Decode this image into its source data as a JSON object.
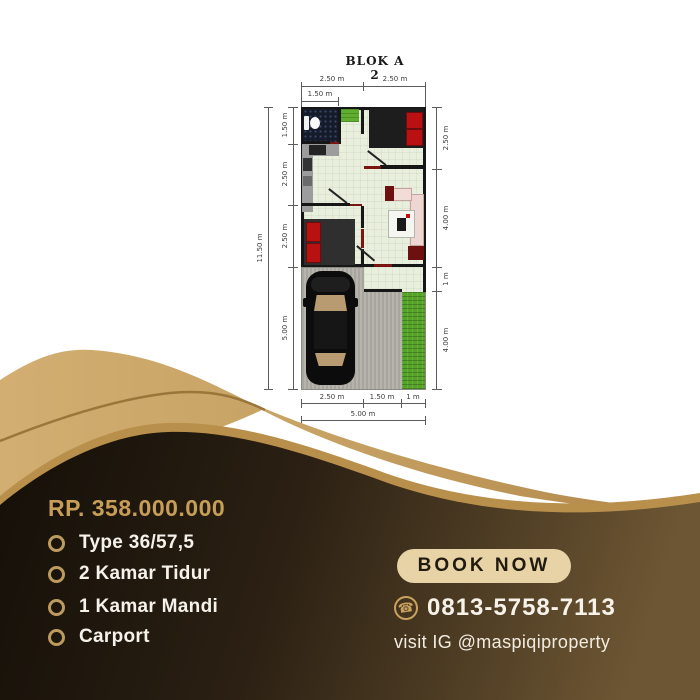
{
  "plan": {
    "title": "BLOK A 2",
    "dims": {
      "top_left_half": "2.50 m",
      "top_right_half": "2.50 m",
      "top_sub": "1.50 m",
      "left_outer": "11.50 m",
      "left_1": "1.50 m",
      "left_2": "2.50 m",
      "left_3": "2.50 m",
      "left_4": "5.00 m",
      "right_1": "2.50 m",
      "right_2": "4.00 m",
      "right_3": "1 m",
      "right_4": "4.00 m",
      "bottom_1": "2.50 m",
      "bottom_2": "1.50 m",
      "bottom_3": "1 m",
      "bottom_total": "5.00 m"
    }
  },
  "offer": {
    "price": "RP. 358.000.000",
    "features": [
      "Type 36/57,5",
      "2 Kamar Tidur",
      "1 Kamar Mandi",
      "Carport"
    ]
  },
  "cta": {
    "book_label": "BOOK NOW",
    "phone": "0813-5758-7113",
    "phone_icon": "☎",
    "instagram": "visit IG @maspiqiproperty"
  },
  "colors": {
    "gold": "#c79e57",
    "tan_wave": "#c8a568",
    "dark_brown": "#171108",
    "light_brown": "#6d5633",
    "button_cream": "#e7d3a6",
    "mattress_red": "#b91111",
    "grass_green": "#55a327"
  }
}
